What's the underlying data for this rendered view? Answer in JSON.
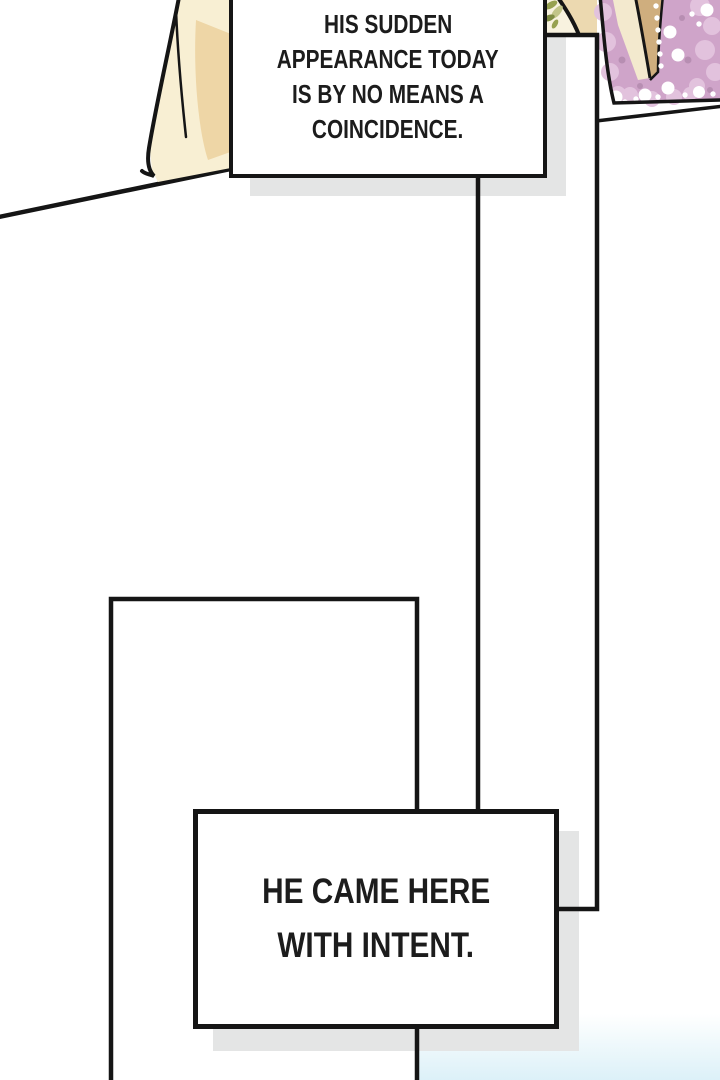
{
  "comic": {
    "bubbles": {
      "top": {
        "line1": "HIS SUDDEN",
        "line2": "APPEARANCE TODAY",
        "line3": "IS BY NO MEANS A",
        "line4": "COINCIDENCE."
      },
      "bottom": {
        "line1": "HE CAME HERE",
        "line2": "WITH INTENT."
      }
    },
    "colors": {
      "line": "#151515",
      "panel_fill": "#ffffff",
      "shadow": "#e4e5e5",
      "drape_cream": "#f8efd3",
      "drape_shade": "#eed6a6",
      "fabric_cream": "#f8f2df",
      "fabric_tan": "#ecd9b0",
      "leaf_olive": "#97a150",
      "leaf_light": "#c3c589",
      "leaf_dark": "#7f8c42",
      "lace_base": "#cfa4c9",
      "lace_light": "#e2c2dd",
      "lace_dark": "#b78eb2",
      "lace_inner_tan": "#cfae7e",
      "lace_inner_cream": "#f3e9ce",
      "pearl": "#ffffff",
      "bottom_tint": "#d8eff7"
    }
  }
}
